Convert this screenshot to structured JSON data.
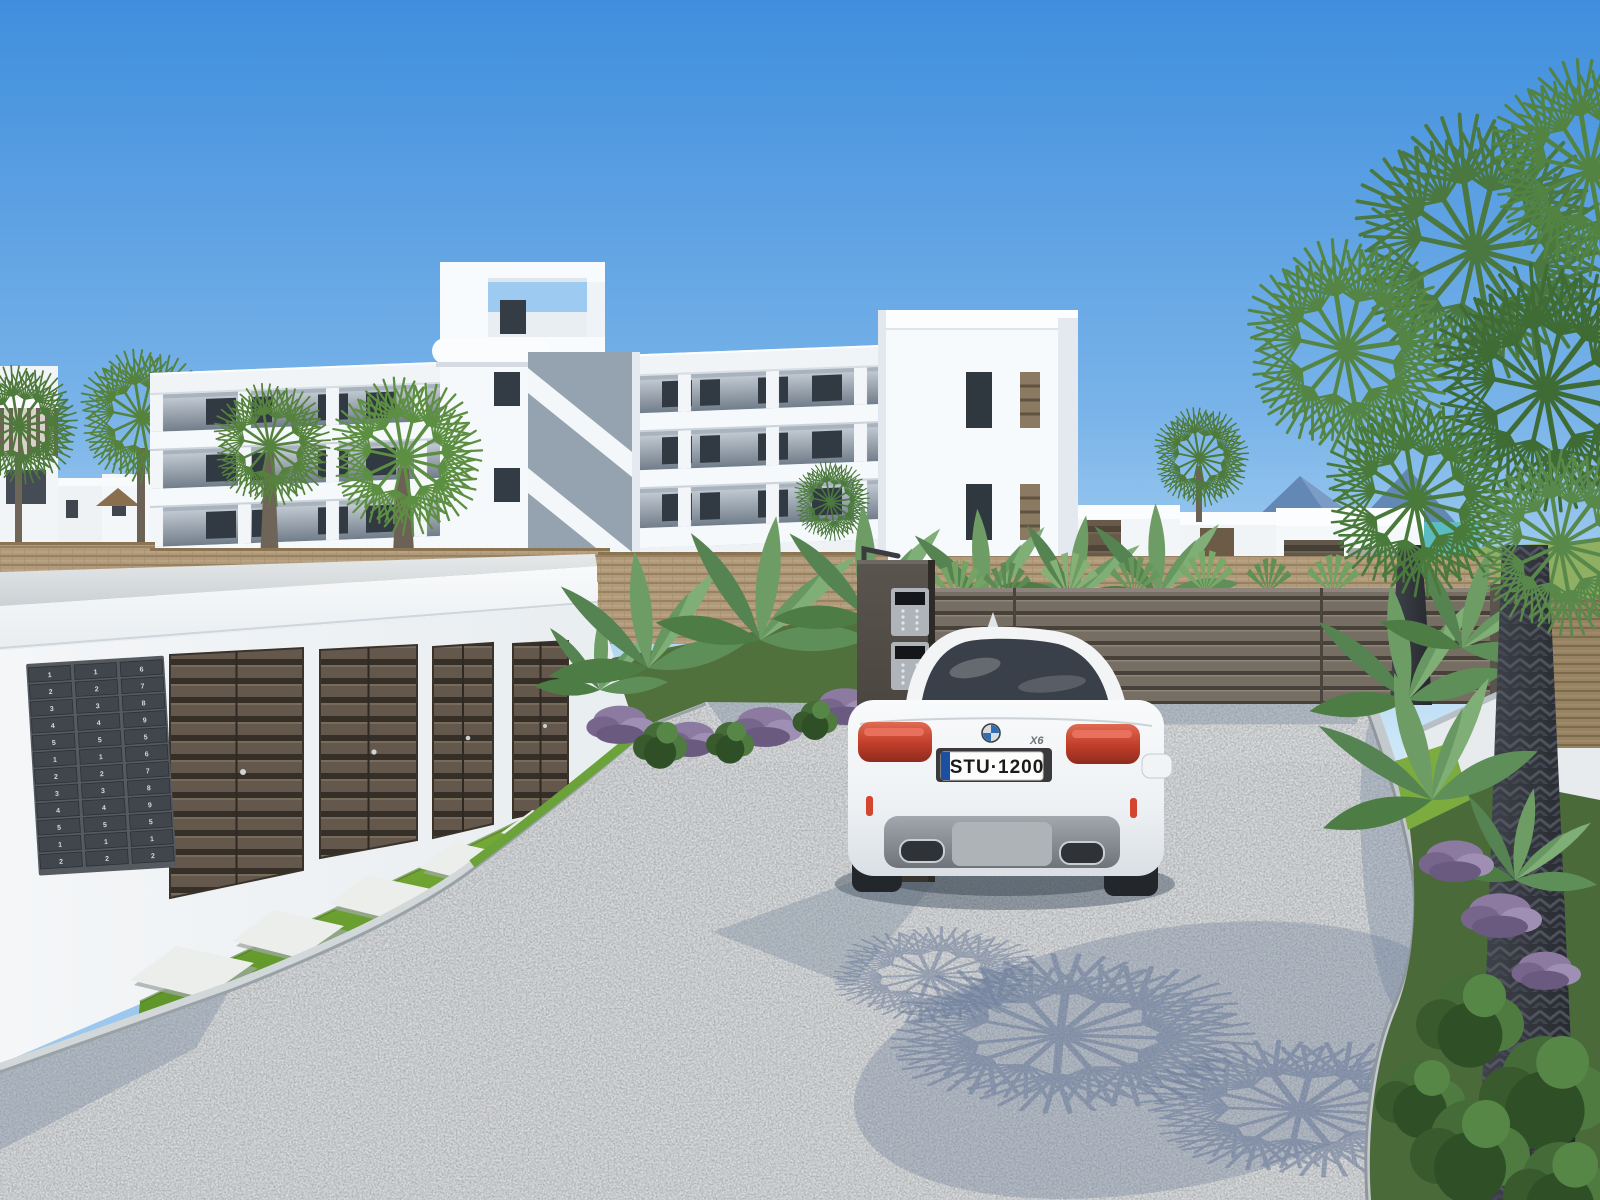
{
  "scene": {
    "description": "3D architectural render of a new-build white apartment complex with private garages, mailbox wall, entrance gate, palm trees and a white SUV on a gravel driveway",
    "time_of_day": "sunny day, clear sky"
  },
  "sky": {
    "top_color": "#3f8edd",
    "horizon_color": "#cfe8f8"
  },
  "apartment_building": {
    "floors": 3,
    "balconies": true,
    "facade_color": "#f4f7fa",
    "window_color": "#313943"
  },
  "garage_block": {
    "door_count": 4,
    "door_color": "#63584b",
    "fascia_color": "#f5f7f9"
  },
  "mailboxes": {
    "columns": [
      [
        "1",
        "2",
        "3",
        "4",
        "5",
        "1",
        "2",
        "3",
        "4",
        "5",
        "1",
        "2"
      ],
      [
        "1",
        "2",
        "3",
        "4",
        "5",
        "1",
        "2",
        "3",
        "4",
        "5",
        "1",
        "2"
      ],
      [
        "6",
        "7",
        "8",
        "9",
        "5",
        "6",
        "7",
        "8",
        "9",
        "5",
        "1",
        "2"
      ]
    ],
    "panel_color": "#555a61"
  },
  "car": {
    "model_badge": "X6",
    "plate_text": "STU·1200",
    "plate_euroband_color": "#1d4fa1",
    "body_color": "#f3f5f7"
  },
  "background_car": {
    "body_color": "#c3c8cc"
  },
  "gate": {
    "slat_color": "#766d63",
    "pillar_color": "#4d4842"
  },
  "landscape": {
    "driveway_color": "#b7babc",
    "grass_color": "#6fa535",
    "wicker_fence_color": "#b19a7b",
    "palm_green": "#4a7840",
    "mountain_color": "#6388b6",
    "sea_color": "#59c2c2",
    "shadow_color": "#5f7294"
  }
}
